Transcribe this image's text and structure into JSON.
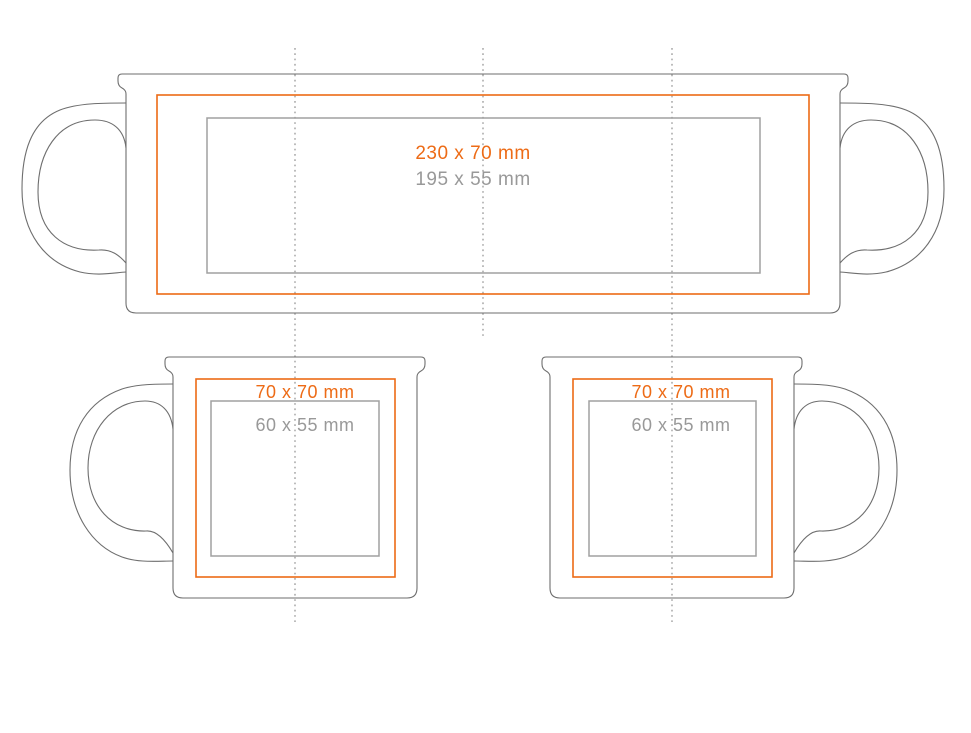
{
  "page": {
    "background_color": "#FFFFFF",
    "description_labels_only": true
  },
  "colors": {
    "print_area_orange": "#ED6B16",
    "safe_area_gray": "#A0A0A0",
    "safe_label_gray": "#999999",
    "mug_outline_gray": "#6E6E6E",
    "guide_line_gray": "#999999"
  },
  "wrap_view": {
    "print_area_label": "230 x 70 mm",
    "safe_area_label": "195 x 55 mm"
  },
  "front_view_left_handle": {
    "print_area_label": "70 x 70 mm",
    "safe_area_label": "60 x 55 mm"
  },
  "front_view_right_handle": {
    "print_area_label": "70 x 70 mm",
    "safe_area_label": "60 x 55 mm"
  }
}
